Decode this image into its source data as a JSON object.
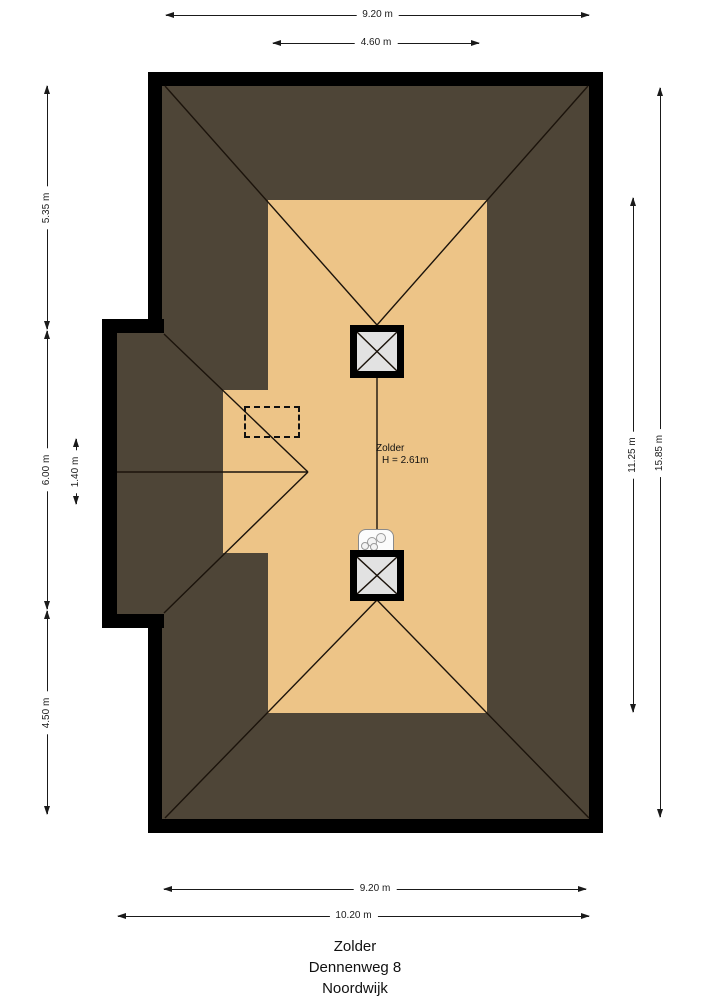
{
  "floorplan": {
    "room": {
      "name": "Zolder",
      "height": "H = 2.61m"
    },
    "dimensions": {
      "top_outer": "9.20 m",
      "top_inner": "4.60 m",
      "left_upper": "5.35 m",
      "left_middle": "6.00 m",
      "left_inner": "1.40 m",
      "left_lower": "4.50 m",
      "right_inner": "11.25 m",
      "right_outer": "15.85 m",
      "bottom_inner": "9.20 m",
      "bottom_outer": "10.20 m"
    },
    "title": {
      "room": "Zolder",
      "street": "Dennenweg 8",
      "city": "Noordwijk"
    },
    "colors": {
      "wall": "#000000",
      "roof": "#4E4537",
      "floor": "#EDC487",
      "chimney_fill": "#E2E2E2",
      "roof_line": "#1B130B"
    }
  }
}
